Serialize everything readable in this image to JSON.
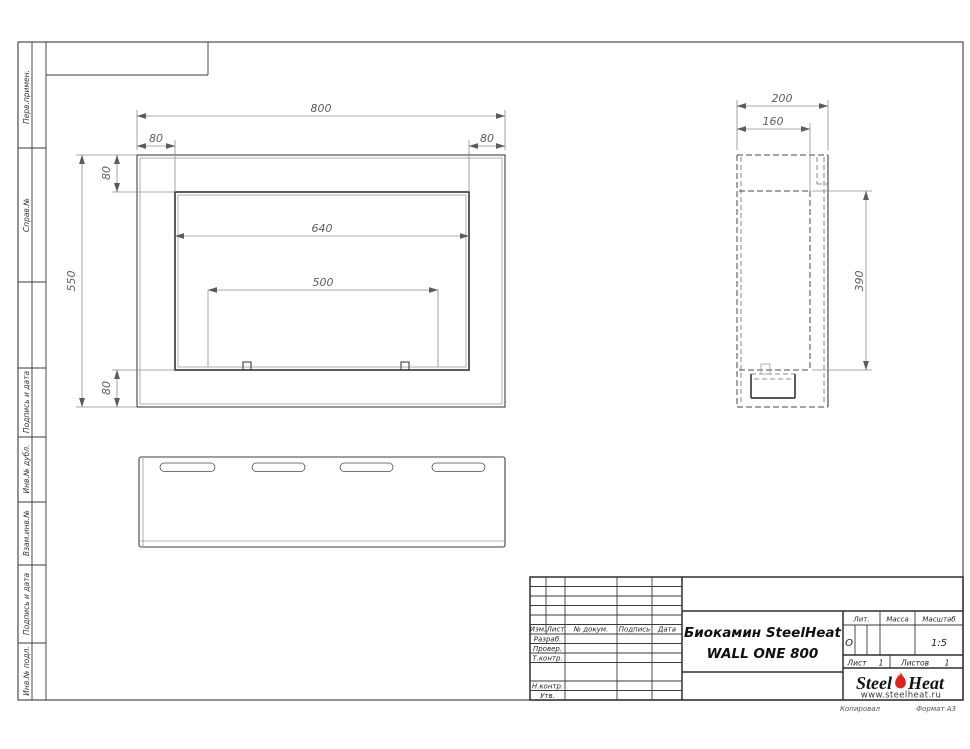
{
  "document": {
    "product_title_line1": "Биокамин SteelHeat",
    "product_title_line2": "WALL ONE 800"
  },
  "front_view": {
    "dim_width_total": "800",
    "dim_margin_left": "80",
    "dim_margin_right": "80",
    "dim_margin_top": "80",
    "dim_margin_bottom": "80",
    "dim_height_total": "550",
    "dim_opening_width": "640",
    "dim_burner_width": "500"
  },
  "side_view": {
    "dim_depth_total": "200",
    "dim_depth_inner": "160",
    "dim_opening_height": "390"
  },
  "sidebar": {
    "top": [
      "Перв.примен.",
      "Справ.№"
    ],
    "bottom": [
      "Подпись и дата",
      "Инв.№ дубл.",
      "Взам.инв.№",
      "Подпись и дата",
      "Инв.№ подл."
    ]
  },
  "title_block": {
    "col_izm": "Изм.",
    "col_list": "Лист",
    "col_doc": "№ докум.",
    "col_sign": "Подпись",
    "col_date": "Дата",
    "row_developed": "Разраб.",
    "row_checked": "Провер.",
    "row_tcontrol": "Т.контр.",
    "row_ncontrol": "Н.контр.",
    "row_approved": "Утв.",
    "lit_label": "Лит.",
    "lit_value": "О",
    "mass_label": "Масса",
    "scale_label": "Масштаб",
    "scale_value": "1:5",
    "sheet_label": "Лист",
    "sheet_value": "1",
    "sheets_label": "Листов",
    "sheets_value": "1"
  },
  "logo": {
    "steel": "Steel",
    "heat": "Heat",
    "url": "www.steelheat.ru",
    "flame_color": "#e2231a"
  },
  "footer": {
    "copied": "Копировал",
    "format": "Формат А3"
  }
}
